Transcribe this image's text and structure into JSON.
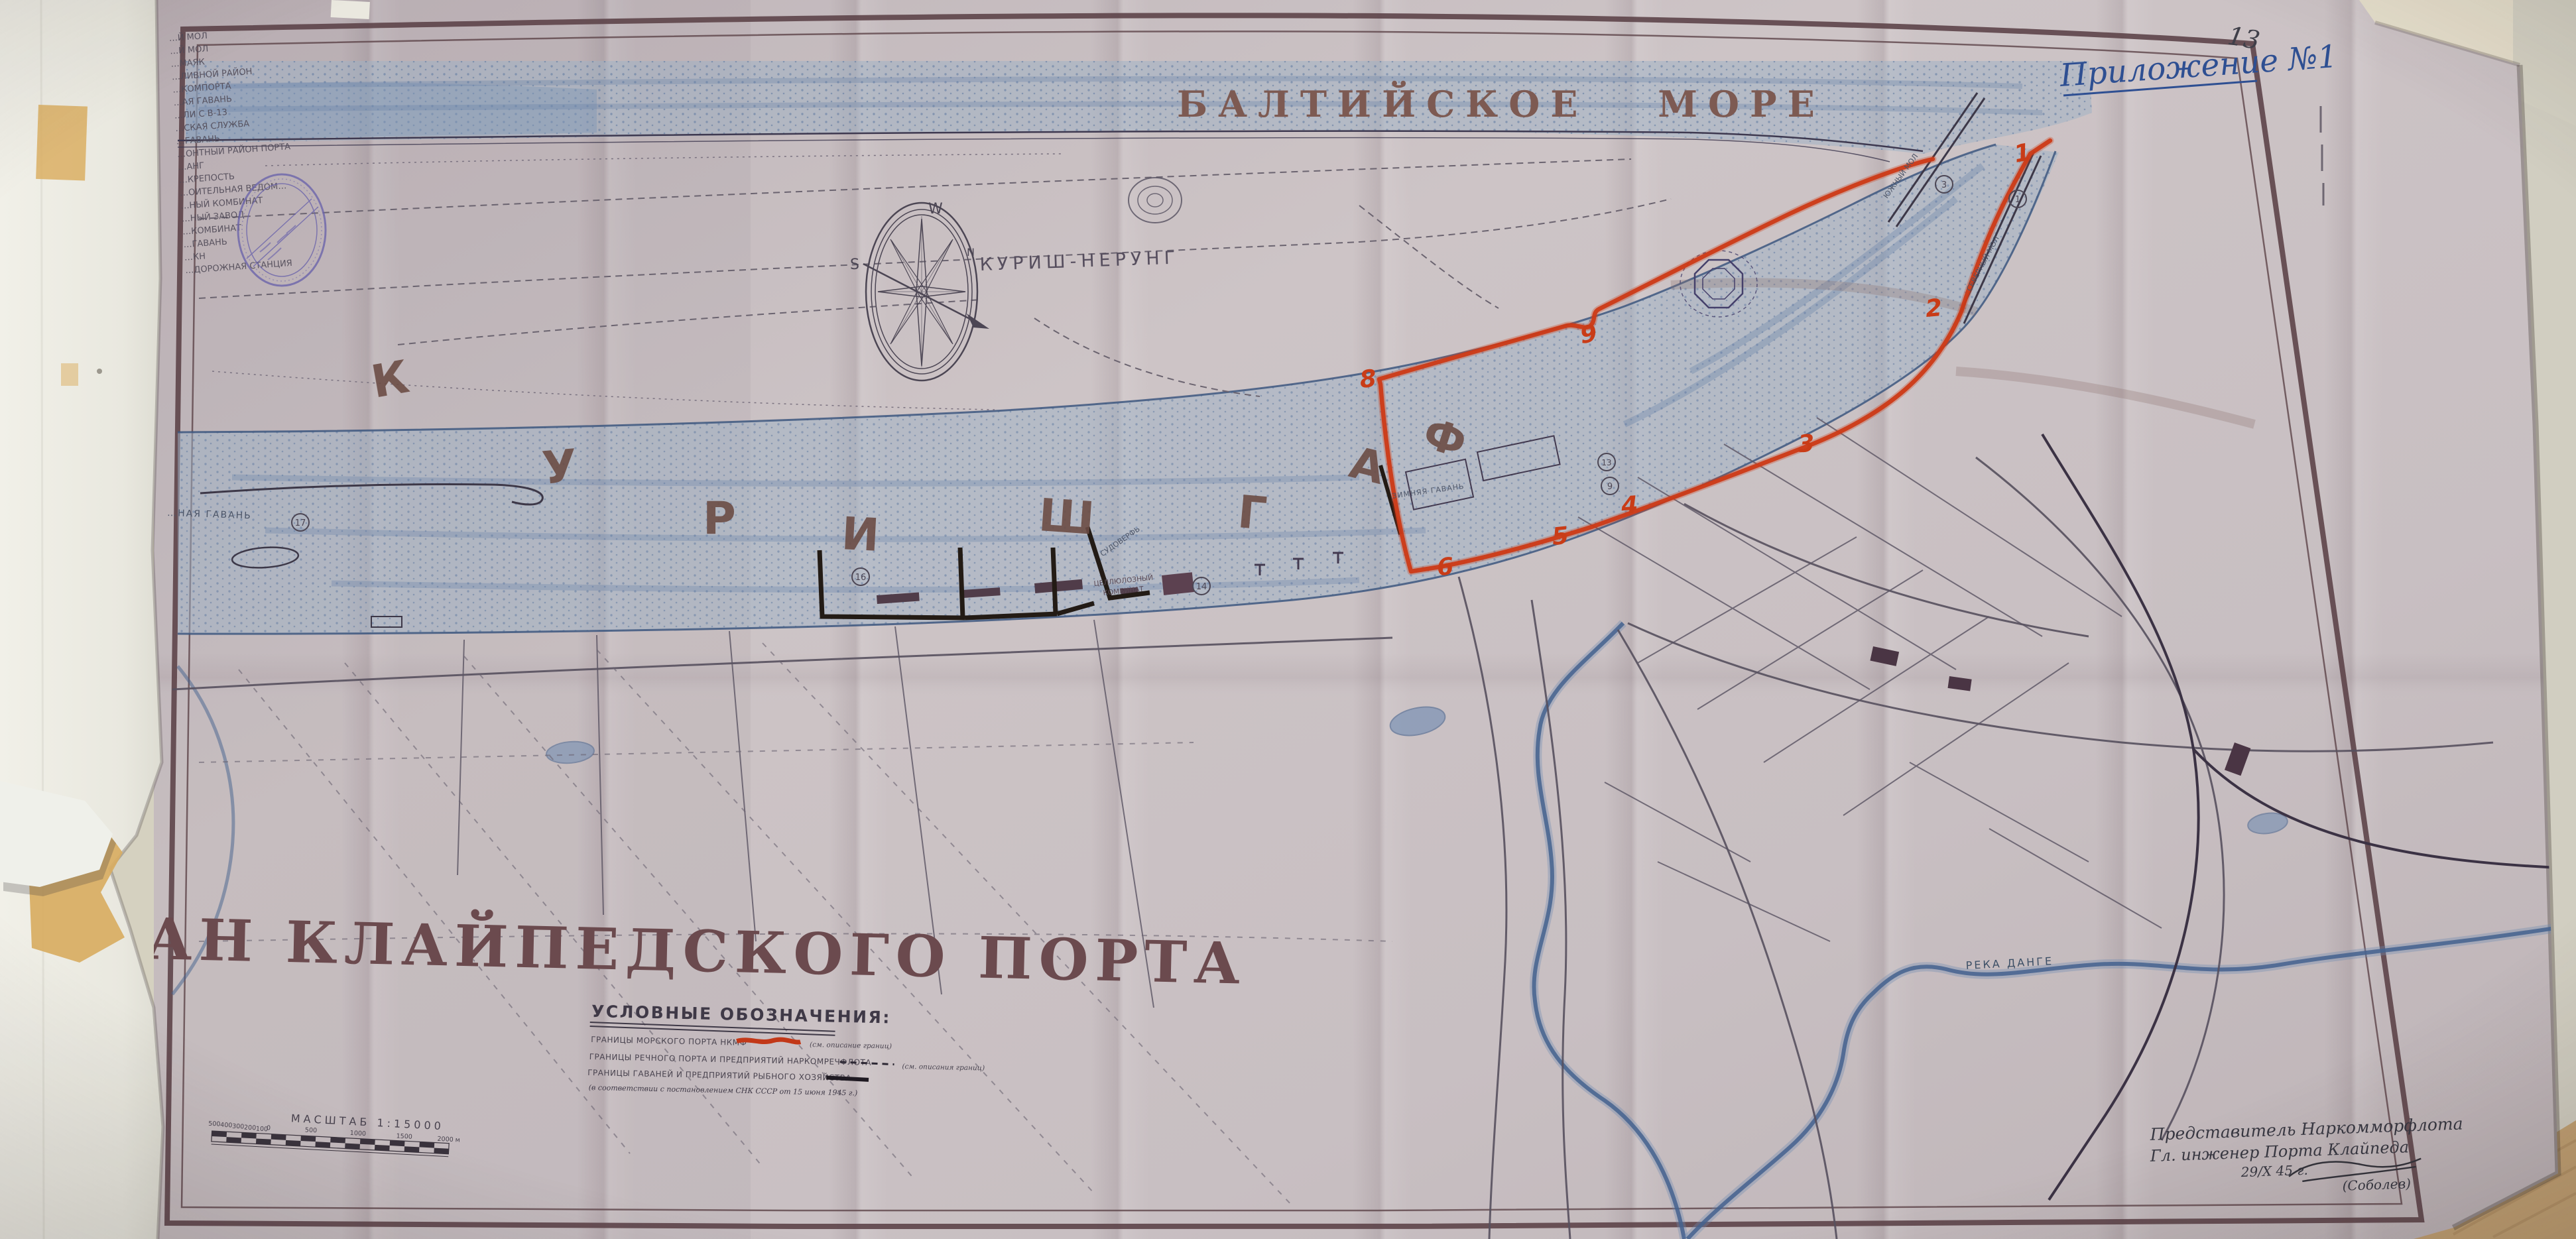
{
  "page": {
    "number": "13",
    "annotation": "Приложение №1"
  },
  "map": {
    "title": "ПЛАН КЛАЙПЕДСКОГО ПОРТА",
    "sea_label": "БАЛТИЙСКОЕ  МОРЕ",
    "spit_label": "КУРИШ-НЕРУНГ",
    "lagoon_name": "КУРИШ ГАФ",
    "lagoon_letters": [
      "К",
      "У",
      "Р",
      "И",
      "Ш",
      "Г",
      "А",
      "Ф"
    ],
    "compass": {
      "w": "W",
      "s": "S",
      "n": "N"
    },
    "river_label": "РЕКА ДАНГЕ",
    "labels": {
      "harbor_left": "…НАЯ ГАВАНЬ",
      "winter_harbor": "ЗИМНЯЯ ГАВАНЬ",
      "cellulose_1": "ЦЕЛЛЮЛОЗНЫЙ",
      "cellulose_2": "КОМБИНАТ",
      "shipyard": "СУДОВЕРФЬ",
      "south_mole": "ЮЖНЫЙ МОЛ",
      "north_mole": "СЕВЕРНЫЙ МОЛ"
    },
    "boundary_numbers": [
      "1",
      "2",
      "3",
      "4",
      "5",
      "6",
      "8",
      "9"
    ],
    "circled_numbers": [
      "17",
      "16",
      "14",
      "13",
      "9",
      "3",
      "1"
    ]
  },
  "margin_list": {
    "items": [
      "…Й МОЛ",
      "…Й МОЛ",
      "…МАЯК",
      "…ЛИВНОЙ РАЙОН",
      "…КОМПОРТА",
      "…АЯ ГАВАНЬ",
      "…ЛИ С В-13",
      "…СКАЯ СЛУЖБА",
      "…ГАВАНЬ",
      "…ОНТНЫЙ РАЙОН ПОРТА",
      "…АНГ",
      "…КРЕПОСТЬ",
      "…ОИТЕЛЬНАЯ ВЕДОМ…",
      "…НЫЙ КОМБИНАТ",
      "…НЫЙ ЗАВОД",
      "…КОМБИНАТ",
      "…ГАВАНЬ",
      "…КН",
      "…ДОРОЖНАЯ СТАНЦИЯ"
    ]
  },
  "legend": {
    "heading": "УСЛОВНЫЕ ОБОЗНАЧЕНИЯ:",
    "rows": [
      {
        "label": "ГРАНИЦЫ МОРСКОГО ПОРТА НКМФ",
        "note": "(см. описание границ)"
      },
      {
        "label": "ГРАНИЦЫ РЕЧНОГО ПОРТА И ПРЕДПРИЯТИЙ НАРКОМРЕЧФЛОТА",
        "note": "(см. описания границ)"
      },
      {
        "label": "ГРАНИЦЫ ГАВАНЕЙ И ПРЕДПРИЯТИЙ РЫБНОГО ХОЗЯЙСТВА",
        "note": ""
      }
    ],
    "footnote": "(в соответствии с постановлением СНК СССР от 15 июня 1945 г.)"
  },
  "scale": {
    "label": "МАСШТАБ 1:15000",
    "ticks": [
      "500",
      "400",
      "300",
      "200",
      "100",
      "0",
      "500",
      "1000",
      "1500",
      "2000 м"
    ]
  },
  "signature": {
    "line1": "Представитель Наркомморфлота",
    "line2": "Гл. инженер Порта Клайпеда",
    "date": "29/X 45 г.",
    "name": "(Соболев)"
  },
  "palette": {
    "paper": "#c8bfc2",
    "desk": "#d5d1c0",
    "wood": "#c2a173",
    "backing_paper": "#edece4",
    "water": "#8ba3bf",
    "boundary_red": "#cc3a17",
    "boundary_black": "#221a14",
    "frame_brown": "#5d4449",
    "lettering_brown": "#6b4c45",
    "ink": "#4c4654",
    "blue_ink": "#2e4f92",
    "stamp_violet": "#6a63ab",
    "tape": "#d9ae62"
  }
}
